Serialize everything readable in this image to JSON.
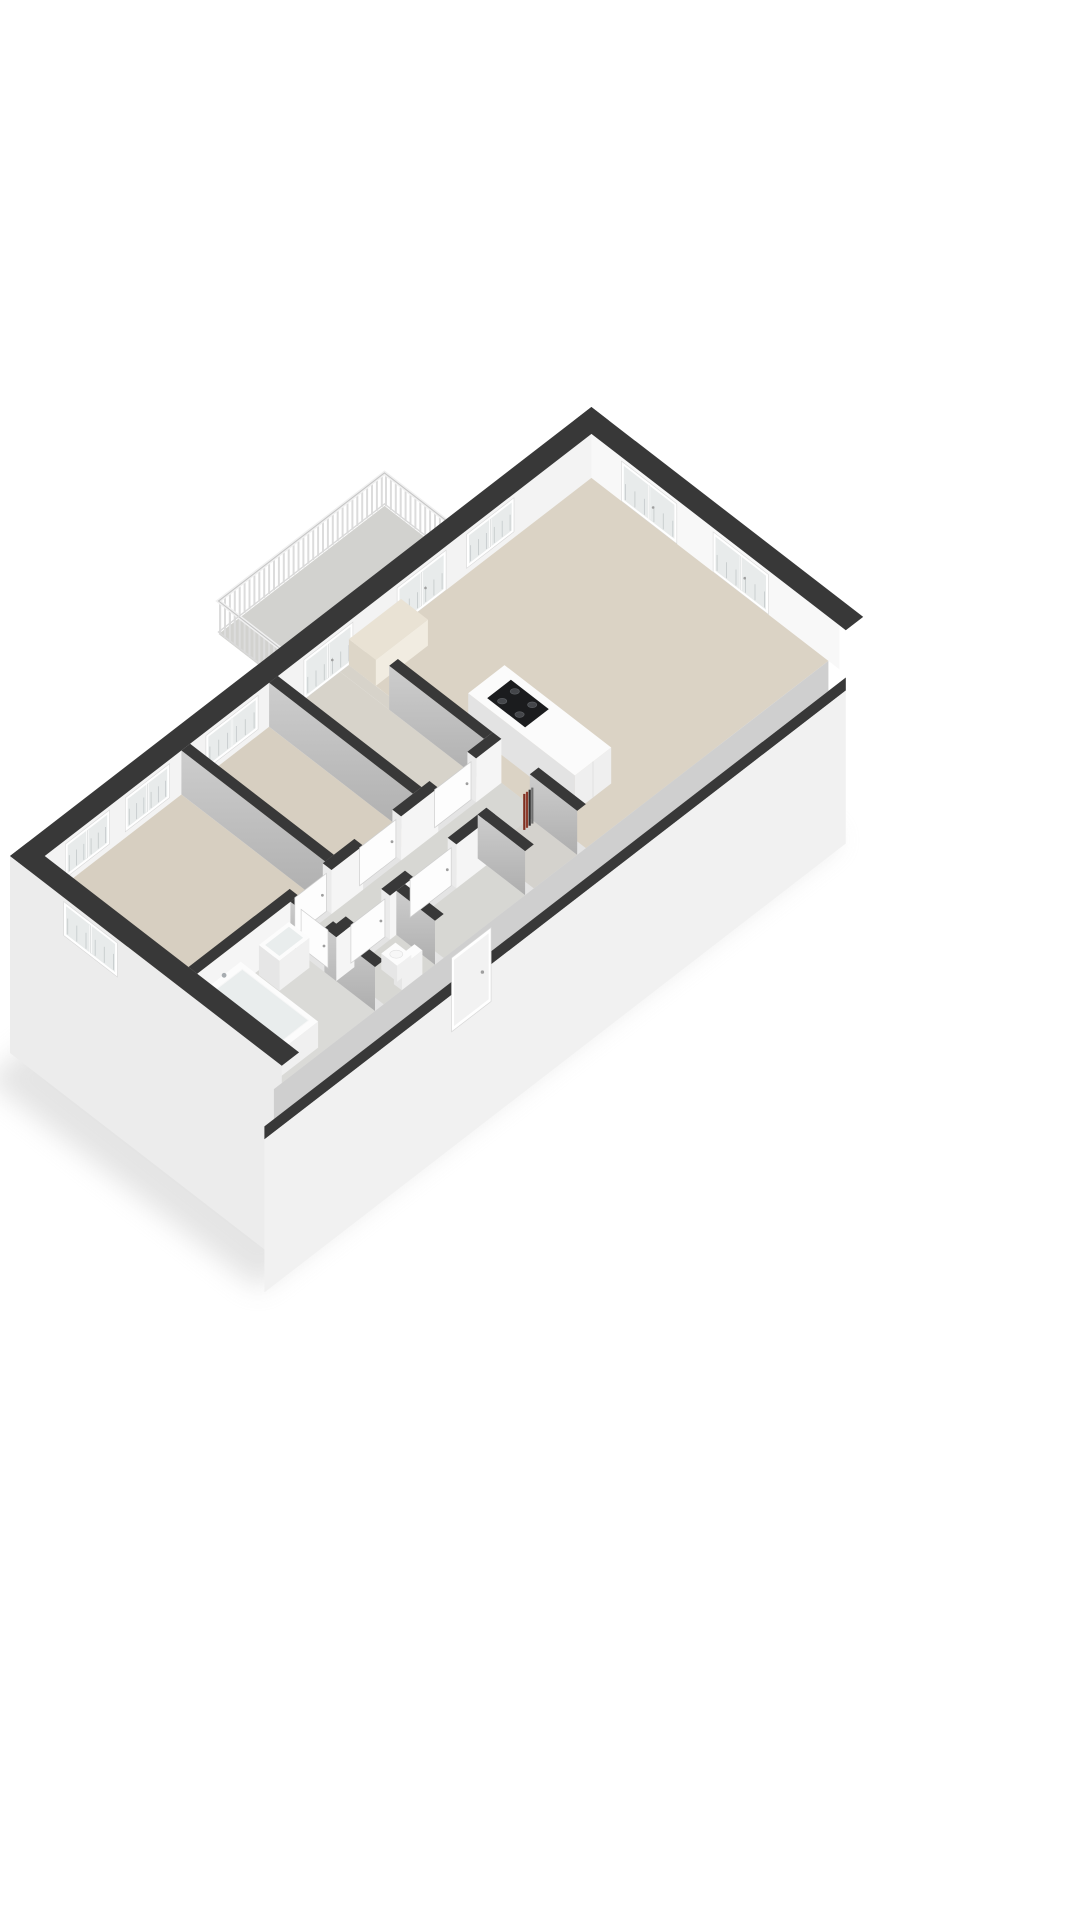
{
  "meta": {
    "background": "#ffffff",
    "view": "3d-axonometric-floorplan"
  },
  "scene": {
    "canvas": {
      "width": 1080,
      "height": 1920
    },
    "transform": {
      "ox": 10,
      "oy": 900,
      "ax": 0.79,
      "ay": 0.61
    },
    "wall": {
      "extT": 22,
      "intT": 11,
      "height": 44,
      "apronDepth": 153,
      "seBand": 30,
      "seCap": 13
    },
    "footprint": [
      0,
      0,
      736,
      344
    ],
    "colors": {
      "cap": "#383838",
      "faceWhite": "#f5f5f5",
      "faceGrayTop": "#cdcdcd",
      "faceGrayBot": "#aeaeae",
      "extInner": "#f3f3f3",
      "neInner": "#f8f8f8",
      "swOuter": "#ececec",
      "apron": "#f1f1f1",
      "seBand": "#cfcfcf",
      "endJamb": "#ebebeb",
      "glass": "#e8ebeb",
      "frame": "#ffffff",
      "bar": "#c7cccd",
      "mullionShade": "#cfd3d3",
      "floorBeige": "#d7cfc1",
      "floorBeigeLight": "#dbd3c5",
      "floorWarmGray": "#d7d3ca",
      "floorGray": "#d7d7d3",
      "floorBathGray": "#dadad7",
      "floorCloset": "#d4d2cd",
      "balconyFloor": "#d2d2cf",
      "fascia": "#e4e4e4",
      "railSlat": "#dcdcdc",
      "railTopLight": "#f0f0f0",
      "railTopDark": "#c6c6c6",
      "railBottom": "#d9d9d9",
      "islandTop": "#fbfbfb",
      "islandSE": "#efefef",
      "islandSW": "#e3e3e3",
      "cooktop": "#1b1c1e",
      "burner": "#44464a",
      "burnerRim": "#5a5d61",
      "tubInner": "#e9eded",
      "fixtureTop": "#fcfcfc",
      "fixtureSE": "#f0f0f0",
      "fixtureSW": "#e6e6e6",
      "metal": "#a7acb0",
      "leaf": "#fdfdfd",
      "leafStroke": "#cfcfcf",
      "handle": "#9e9e9e",
      "cabinetTop": "#e9e2d4",
      "cabinetSE": "#f1ece1",
      "cabinetSW": "#ddd6c8",
      "shadow": "#bdbdbd"
    },
    "balcony": {
      "x0": 350,
      "x1": 560,
      "depth": 86,
      "slatStep": 6.2,
      "railHeight": 33,
      "slatTop": 31
    },
    "floors": [
      {
        "name": "room-floor-bedroom-1",
        "rect": [
          22,
          22,
          195,
          204
        ],
        "color": "floorBeige"
      },
      {
        "name": "room-floor-bedroom-2",
        "rect": [
          206,
          22,
          306,
          204
        ],
        "color": "floorBeige"
      },
      {
        "name": "room-floor-study",
        "rect": [
          317,
          22,
          396,
          204
        ],
        "color": "floorWarmGray"
      },
      {
        "name": "room-floor-passage",
        "rect": [
          396,
          22,
          407,
          84
        ],
        "color": "floorWarmGray"
      },
      {
        "name": "room-floor-living-room",
        "rect": [
          407,
          22,
          714,
          322
        ],
        "color": "floorBeigeLight"
      },
      {
        "name": "room-floor-hallway",
        "rect": [
          151,
          215,
          407,
          262
        ],
        "color": "floorGray"
      },
      {
        "name": "room-floor-bathroom",
        "rect": [
          22,
          215,
          140,
          322
        ],
        "color": "floorBathGray"
      },
      {
        "name": "room-floor-wc",
        "rect": [
          151,
          273,
          216,
          322
        ],
        "color": "floorGray"
      },
      {
        "name": "room-floor-entry-hall",
        "rect": [
          227,
          273,
          330,
          322
        ],
        "color": "floorGray"
      },
      {
        "name": "room-floor-meter-closet",
        "rect": [
          341,
          262,
          396,
          322
        ],
        "color": "floorCloset"
      }
    ],
    "interiorWalls": [
      {
        "name": "wall-living-divider",
        "along": "y",
        "x": 396,
        "y0": 22,
        "y1": 322,
        "face": "gray",
        "openings": [
          [
            22,
            84
          ],
          [
            204,
            262
          ]
        ]
      },
      {
        "name": "wall-bed2-study",
        "along": "y",
        "x": 306,
        "y0": 22,
        "y1": 204,
        "face": "gray",
        "openings": []
      },
      {
        "name": "wall-bed1-bed2",
        "along": "y",
        "x": 195,
        "y0": 22,
        "y1": 204,
        "face": "gray",
        "openings": []
      },
      {
        "name": "wall-corridor-nw",
        "along": "x",
        "y": 204,
        "x0": 22,
        "x1": 407,
        "face": "white",
        "openings": [
          [
            150,
            192
          ],
          [
            232,
            280
          ],
          [
            327,
            375
          ]
        ]
      },
      {
        "name": "wall-bathroom-east",
        "along": "y",
        "x": 140,
        "y0": 215,
        "y1": 322,
        "face": "gray",
        "openings": [
          [
            222,
            258
          ]
        ]
      },
      {
        "name": "wall-corridor-se",
        "along": "x",
        "y": 262,
        "x0": 140,
        "x1": 341,
        "face": "white",
        "openings": [
          [
            163,
            208
          ],
          [
            238,
            292
          ]
        ]
      },
      {
        "name": "wall-wc-side",
        "along": "y",
        "x": 216,
        "y0": 273,
        "y1": 322,
        "face": "gray",
        "openings": []
      },
      {
        "name": "wall-entry-side",
        "along": "y",
        "x": 330,
        "y0": 262,
        "y1": 322,
        "face": "gray",
        "openings": []
      }
    ],
    "doors": [
      {
        "name": "door-bedroom-1",
        "along": "x",
        "yc": 209.5,
        "from": 151,
        "to": 191
      },
      {
        "name": "door-bedroom-2",
        "along": "x",
        "yc": 209.5,
        "from": 233,
        "to": 279
      },
      {
        "name": "door-study",
        "along": "x",
        "yc": 209.5,
        "from": 328,
        "to": 374
      },
      {
        "name": "door-wc",
        "along": "x",
        "yc": 267.5,
        "from": 164,
        "to": 207
      },
      {
        "name": "door-entry-hall",
        "along": "x",
        "yc": 267.5,
        "from": 239,
        "to": 291
      },
      {
        "name": "door-bathroom",
        "along": "y",
        "xc": 145.5,
        "from": 223,
        "to": 257
      }
    ],
    "windows": [
      {
        "name": "window-bedroom-1-a",
        "wall": "nw",
        "from": 48,
        "to": 104,
        "style": "window"
      },
      {
        "name": "window-bedroom-1-b",
        "wall": "nw",
        "from": 124,
        "to": 180,
        "style": "window"
      },
      {
        "name": "window-bedroom-2",
        "wall": "nw",
        "from": 226,
        "to": 292,
        "style": "window"
      },
      {
        "name": "balcony-door-study",
        "wall": "nw",
        "from": 350,
        "to": 412,
        "style": "door"
      },
      {
        "name": "balcony-door-living",
        "wall": "nw",
        "from": 468,
        "to": 530,
        "style": "door"
      },
      {
        "name": "window-living-nw",
        "wall": "nw",
        "from": 556,
        "to": 616,
        "style": "window"
      },
      {
        "name": "french-window-living-a",
        "wall": "ne",
        "from": 60,
        "to": 130,
        "style": "door"
      },
      {
        "name": "french-window-living-b",
        "wall": "ne",
        "from": 176,
        "to": 246,
        "style": "door"
      },
      {
        "name": "window-bedroom-1-sw",
        "wall": "sw",
        "from": 68,
        "to": 136,
        "style": "window"
      }
    ],
    "entranceDoor": {
      "from": 240,
      "to": 284
    },
    "pipes": {
      "x": 383,
      "y": 268,
      "count": 4,
      "step": 3.4,
      "height": 36,
      "colors": [
        "#7e2f20",
        "#8d3a2b",
        "#303030",
        "#6f6f6f"
      ]
    },
    "furniture": {
      "cabinet": {
        "rect": [
          407,
          22,
          473,
          56
        ],
        "h": 26
      },
      "island": {
        "rect": [
          430,
          150,
          476,
          285
        ],
        "h": 36
      },
      "cooktop": {
        "rect": [
          438,
          166,
          468,
          214
        ],
        "burners": [
          [
            445,
            178
          ],
          [
            461,
            178
          ],
          [
            445,
            200
          ],
          [
            461,
            200
          ]
        ]
      },
      "bathtub": {
        "rect": [
          26,
          218,
          74,
          316
        ],
        "h": 26
      },
      "sink": {
        "rect": [
          96,
          219,
          134,
          245
        ],
        "h": 30
      },
      "toiletTank": {
        "rect": [
          174,
          312,
          200,
          322
        ],
        "h": 24
      },
      "toiletBowl": {
        "rect": [
          178,
          292,
          196,
          312
        ],
        "h": 16
      }
    }
  }
}
